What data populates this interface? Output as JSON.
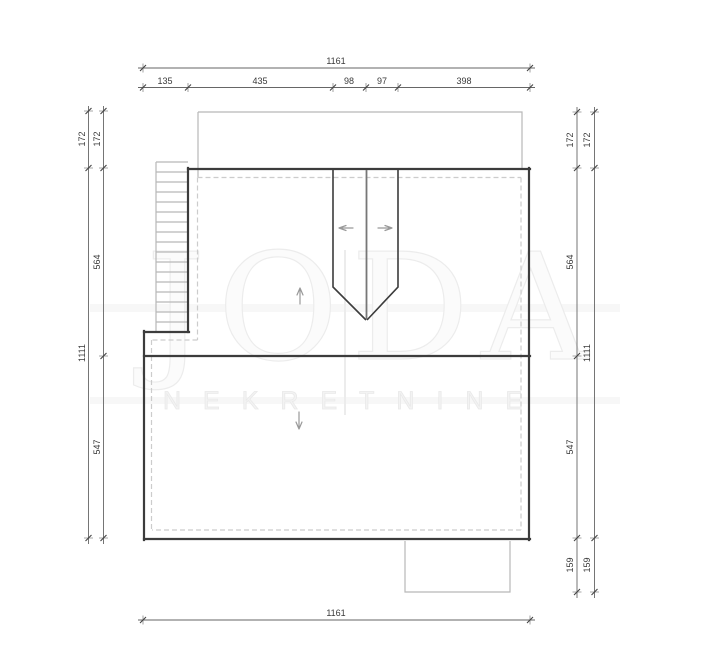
{
  "title": "attic floor plan",
  "watermark": {
    "brand": "JODA",
    "subtitle": "NEKRETNINE"
  },
  "dimensions": {
    "top_total": "1161",
    "top_segments": [
      "135",
      "435",
      "98",
      "97",
      "398"
    ],
    "left_outer": [
      "172",
      "1111"
    ],
    "left_inner": [
      "172",
      "564",
      "547"
    ],
    "right_inner": [
      "172",
      "564",
      "547",
      "159"
    ],
    "right_outer": [
      "172",
      "1111",
      "159"
    ],
    "bottom_total": "1161"
  },
  "icons": {
    "ridge_left": "arrow-left-icon",
    "ridge_right": "arrow-right-icon",
    "slope_up": "arrow-up-icon",
    "slope_down": "arrow-down-icon"
  },
  "colors": {
    "wall": "#3c3c3c",
    "light_line": "#b8b8b8",
    "dashed_line": "#cccccc",
    "dim_line": "#666666",
    "dim_text": "#3a3a3a",
    "watermark": "#ececec",
    "arrow": "#999999",
    "center_line": "#777777",
    "background": "#ffffff"
  }
}
